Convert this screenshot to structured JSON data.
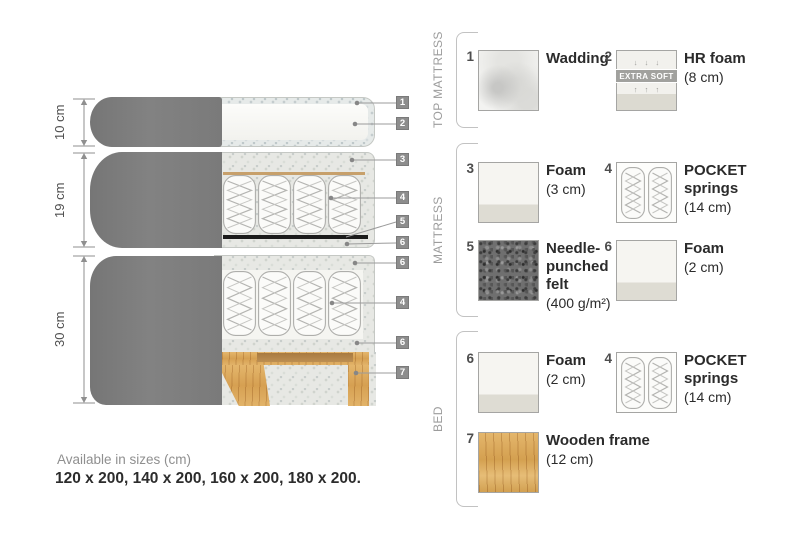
{
  "diagram": {
    "measurements": [
      {
        "label": "10 cm"
      },
      {
        "label": "19 cm"
      },
      {
        "label": "30 cm"
      }
    ],
    "callouts": [
      "1",
      "2",
      "3",
      "4",
      "5",
      "6",
      "6",
      "4",
      "6",
      "7"
    ]
  },
  "legend": {
    "sections": [
      {
        "title": "TOP MATTRESS",
        "items": [
          {
            "number": "1",
            "name": "Wadding",
            "size": "",
            "swatch": "wadding"
          },
          {
            "number": "2",
            "name": "HR foam",
            "size": "(8 cm)",
            "swatch": "hrfoam",
            "badge": "EXTRA SOFT",
            "arrows_down": "↓ ↓ ↓",
            "arrows_up": "↑ ↑ ↑"
          }
        ]
      },
      {
        "title": "MATTRESS",
        "items": [
          {
            "number": "3",
            "name": "Foam",
            "size": "(3 cm)",
            "swatch": "foam"
          },
          {
            "number": "4",
            "name": "POCKET\nsprings",
            "size": "(14 cm)",
            "swatch": "springs"
          },
          {
            "number": "5",
            "name": "Needle-\npunched\nfelt",
            "size": "(400 g/m²)",
            "swatch": "felt"
          },
          {
            "number": "6",
            "name": "Foam",
            "size": "(2 cm)",
            "swatch": "foam"
          }
        ]
      },
      {
        "title": "BED",
        "items": [
          {
            "number": "6",
            "name": "Foam",
            "size": "(2 cm)",
            "swatch": "foam"
          },
          {
            "number": "4",
            "name": "POCKET\nsprings",
            "size": "(14 cm)",
            "swatch": "springs"
          },
          {
            "number": "7",
            "name": "Wooden frame",
            "size": "(12 cm)",
            "swatch": "wood"
          }
        ]
      }
    ]
  },
  "footer": {
    "line1": "Available in sizes (cm)",
    "line2": "120 x 200, 140 x 200, 160 x 200, 180 x 200."
  },
  "colors": {
    "fabric": "#7d7d7d",
    "foam_speckle": "#e7e8e4",
    "wood": "#dcab60",
    "felt_line": "#1b1b1b",
    "tan_line": "#c7a06b",
    "callout_badge": "#8d8d8d"
  }
}
